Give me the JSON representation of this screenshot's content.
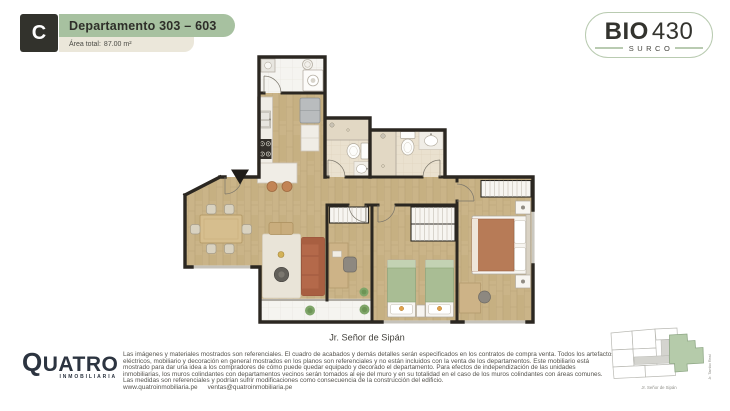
{
  "header": {
    "unit_letter": "C",
    "title": "Departamento 303 – 603",
    "area_label": "Área total:",
    "area_value": "87.00 m²"
  },
  "project_logo": {
    "name": "BIO",
    "number": "430",
    "district": "SURCO"
  },
  "floor_plan": {
    "street_label": "Jr. Señor de Sipán"
  },
  "footer": {
    "brand_name": "QUATRO",
    "brand_tagline": "INMOBILIARIA",
    "disclaimer_lines": [
      "Las imágenes y materiales mostrados son referenciales. El cuadro de acabados y demás detalles serán especificados en los contratos de compra venta. Todos los artefactos",
      "eléctricos, mobiliario y decoración en general mostrados en los planos son referenciales y no están incluidos con la venta de los departamentos. Este mobiliario está",
      "mostrado para dar una idea a los compradores de cómo puede quedar equipado y decorado el departamento. Para efectos de independización de las unidades",
      "inmobiliarias, los muros colindantes con departamentos vecinos serán tomados al eje del muro y en su totalidad en el caso de los muros colindantes con áreas comunes.",
      "Las medidas son referenciales y podrían sufrir modificaciones como consecuencia de la construcción del edificio."
    ],
    "website": "www.quatroinmobiliaria.pe",
    "email": "ventas@quatroinmobiliaria.pe"
  },
  "minimap": {
    "street_bottom": "Jr. Señor de Sipán",
    "street_right": "Jr. Tambo Real"
  },
  "colors": {
    "accent_green": "#a7c1a0",
    "badge_dark": "#32322c",
    "area_strip": "#ebe7da",
    "wall": "#2b2721",
    "wood_floor": "#cab386",
    "tile_floor": "#eae1cf",
    "sofa_terracotta": "#b4694a",
    "bed_green": "#a9bd94",
    "bed_terracotta": "#b77b57",
    "minimap_highlight": "#b5cbaa"
  }
}
